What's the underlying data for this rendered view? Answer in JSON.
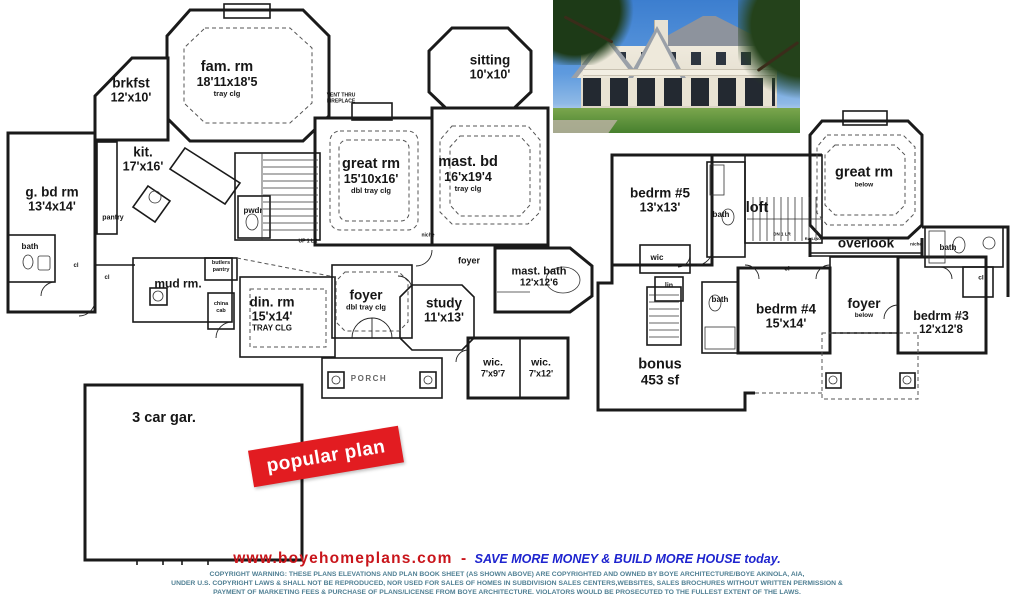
{
  "banner": {
    "label": "popular plan"
  },
  "photo": {
    "label": "rear exterior photo of house"
  },
  "floor1": {
    "rooms": {
      "brkfst": {
        "name": "brkfst",
        "dims": "12'x10'"
      },
      "fam": {
        "name": "fam. rm",
        "dims": "18'11x18'5",
        "note": "tray clg"
      },
      "sitting": {
        "name": "sitting",
        "dims": "10'x10'"
      },
      "kit": {
        "name": "kit.",
        "dims": "17'x16'"
      },
      "great": {
        "name": "great rm",
        "dims": "15'10x16'",
        "note": "dbl tray clg"
      },
      "mastbd": {
        "name": "mast. bd",
        "dims": "16'x19'4",
        "note": "tray clg"
      },
      "gbdrm": {
        "name": "g. bd rm",
        "dims": "13'4x14'"
      },
      "mudrm": {
        "name": "mud rm."
      },
      "dinrm": {
        "name": "din. rm",
        "dims": "15'x14'",
        "note": "TRAY CLG"
      },
      "foyer": {
        "name": "foyer",
        "note": "dbl tray clg"
      },
      "study": {
        "name": "study",
        "dims": "11'x13'"
      },
      "mastbath": {
        "name": "mast. bath",
        "dims": "12'x12'6"
      },
      "wic1": {
        "name": "wic.",
        "dims": "7'x9'7"
      },
      "wic2": {
        "name": "wic.",
        "dims": "7'x12'"
      },
      "porch": {
        "name": "PORCH"
      },
      "garage": {
        "name": "3 car gar."
      }
    },
    "labels": {
      "pwdr": "pwdr",
      "bath": "bath",
      "pantry": "pantry",
      "butlers1": "butlers",
      "butlers2": "pantry",
      "china1": "china",
      "china2": "cab",
      "foyer_small": "foyer",
      "cl1": "cl",
      "cl2": "cl",
      "niche": "niche",
      "up": "UP 1 LR",
      "vent1": "VENT THRU",
      "vent2": "FIREPLACE"
    }
  },
  "floor2": {
    "rooms": {
      "bedrm5": {
        "name": "bedrm #5",
        "dims": "13'x13'"
      },
      "loft": {
        "name": "loft"
      },
      "great2": {
        "name": "great rm",
        "note": "below"
      },
      "overlook": {
        "name": "overlook"
      },
      "bedrm4": {
        "name": "bedrm #4",
        "dims": "15'x14'"
      },
      "foyer2": {
        "name": "foyer",
        "note": "below"
      },
      "bedrm3": {
        "name": "bedrm #3",
        "dims": "12'x12'8"
      },
      "bonus": {
        "name": "bonus",
        "dims": "453 sf"
      }
    },
    "labels": {
      "bath_a": "bath",
      "bath_b": "bath",
      "bath_c": "bath",
      "wic": "wic",
      "lin": "lin",
      "cl_a": "cl",
      "cl_b": "cl",
      "niche": "niche",
      "dn": "DN 1 LR",
      "railing": "RAILING"
    }
  },
  "footer": {
    "site": "www.boyehomeplans.com",
    "sep": "-",
    "tagline": "SAVE MORE MONEY & BUILD MORE HOUSE today.",
    "copyright": [
      "COPYRIGHT WARNING: THESE PLANS ELEVATIONS AND PLAN BOOK SHEET (AS SHOWN ABOVE) ARE COPYRIGHTED AND OWNED BY BOYE ARCHITECTURE/BOYE AKINOLA, AIA,",
      "UNDER U.S. COPYRIGHT LAWS & SHALL NOT BE REPRODUCED, NOR USED FOR SALES OF HOMES IN SUBDIVISION SALES CENTERS,WEBSITES, SALES BROCHURES WITHOUT WRITTEN PERMISSION &",
      "PAYMENT OF MARKETING FEES & PURCHASE OF  PLANS/LICENSE FROM  BOYE ARCHITECTURE. VIOLATORS  WOULD BE PROSECUTED TO THE FULLEST EXTENT OF THE LAWS."
    ]
  },
  "colors": {
    "banner_red": "#e21c21",
    "site_red": "#c9151b",
    "tagline_blue": "#1e24cf",
    "copyright_teal": "#4f7f93",
    "wall_black": "#1a1a1a"
  }
}
